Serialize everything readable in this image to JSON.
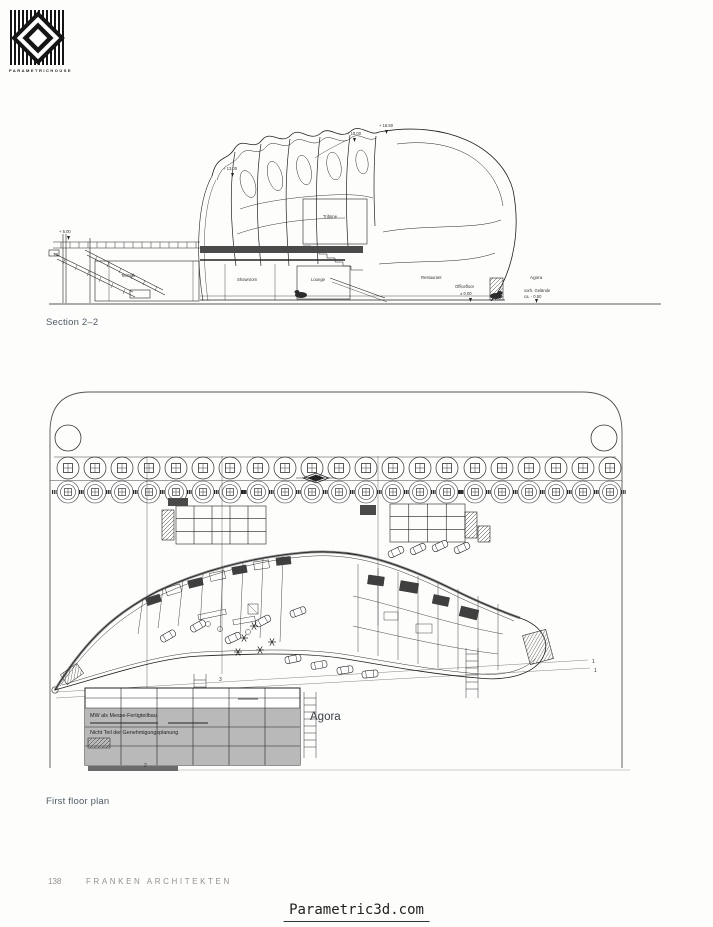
{
  "logo": {
    "brand": "PARAMETRICHOUSE"
  },
  "section_drawing": {
    "caption": "Section 2–2",
    "labels": {
      "t2": "T2",
      "technik": "Technik",
      "tribuene": "Tribüne",
      "showroom": "Showroom",
      "lounge": "Lounge",
      "restaurant": "Restaurant",
      "officefloor": "Officefloor",
      "agora": "Agora"
    },
    "elevations": {
      "top_right": "+ 18.50",
      "top_mid": "+ 18.00",
      "dome": "+ 13.00",
      "walkway": "+ 5.00",
      "ground_right": "± 0.00",
      "ground_agora_1": "vorh. Gelände",
      "ground_agora_2": "ca. - 0.50"
    }
  },
  "floor_plan": {
    "caption": "First floor plan",
    "agora_label": "Agora",
    "note": {
      "line1": "MW als Messe-Fertigteilbau",
      "line3": "Nicht Teil der Genehmigungsplanung"
    },
    "cut_markers": {
      "m1a": "1",
      "m1b": "1",
      "m2": "2",
      "m3": "3"
    }
  },
  "footer": {
    "page_number": "138",
    "studio": "FRANKEN ARCHITEKTEN"
  },
  "watermark": {
    "site": "Parametric3d.com"
  }
}
